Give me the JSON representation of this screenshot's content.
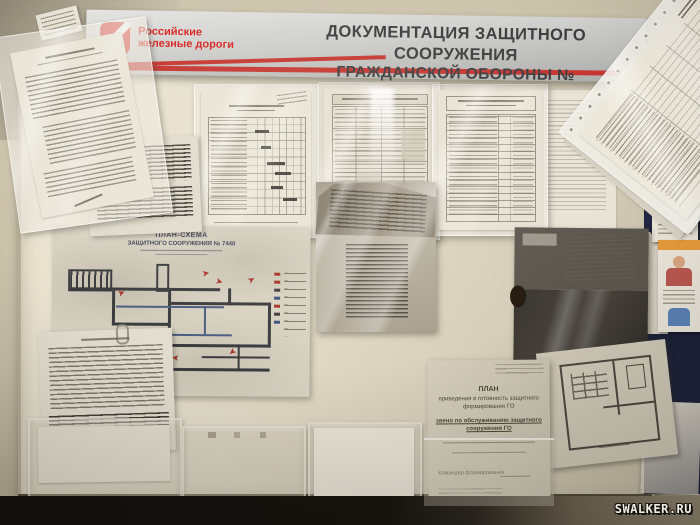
{
  "photo": {
    "watermark": "SWALKER.RU"
  },
  "banner": {
    "logo_line1": "Российские",
    "logo_line2": "железные дороги",
    "title_line1": "ДОКУМЕНТАЦИЯ ЗАЩИТНОГО СООРУЖЕНИЯ",
    "title_line2": "ГРАЖДАНСКОЙ ОБОРОНЫ №"
  },
  "plan_schema": {
    "title": "ПЛАН-СХЕМА",
    "subtitle": "ЗАЩИТНОГО СООРУЖЕНИЯ № 7440"
  },
  "readiness_plan": {
    "title": "ПЛАН",
    "line1": "приведения в готовность защитного",
    "line2": "формирования ГО",
    "line3": "звено по обслуживанию защитного",
    "line4": "сооружения ГО",
    "line5": "Командир формирования"
  },
  "icons": {
    "red_arrow": "➤"
  },
  "colors": {
    "accent_red": "#c5342e",
    "rzd_red": "#d8231f",
    "wall_tan": "#c8bfa8",
    "board_cream": "#e3dcc9",
    "navy_board": "#232947",
    "floor_dark": "#18150f"
  }
}
